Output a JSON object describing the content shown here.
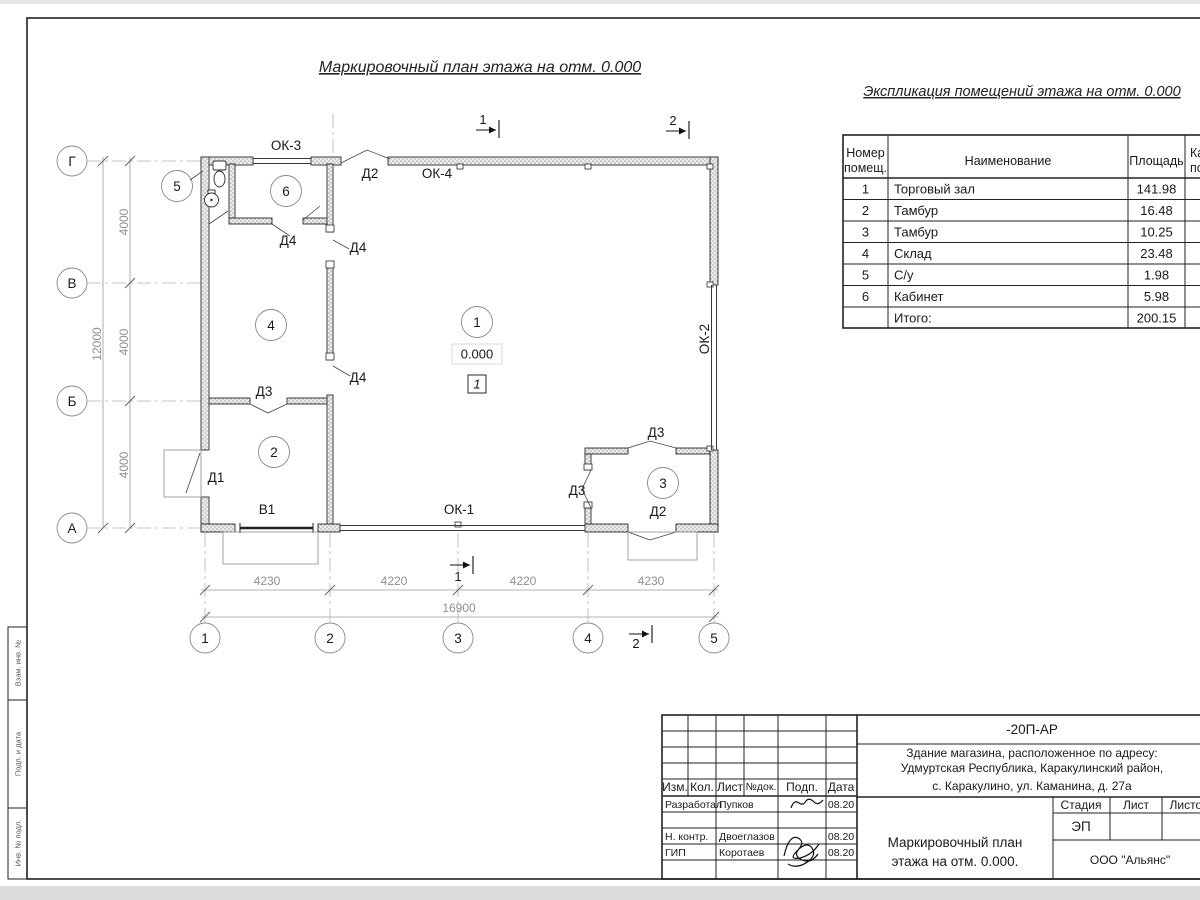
{
  "titles": {
    "main": "Маркировочный план этажа на отм. 0.000",
    "spec": "Экспликация помещений этажа на отм. 0.000"
  },
  "spec_table": {
    "header": {
      "num1": "Номер",
      "num2": "помещ.",
      "name": "Наименование",
      "area": "Площадь",
      "cut1": "Ка",
      "cut2": "по"
    },
    "rows": [
      {
        "num": "1",
        "name": "Торговый зал",
        "area": "141.98"
      },
      {
        "num": "2",
        "name": "Тамбур",
        "area": "16.48"
      },
      {
        "num": "3",
        "name": "Тамбур",
        "area": "10.25"
      },
      {
        "num": "4",
        "name": "Склад",
        "area": "23.48"
      },
      {
        "num": "5",
        "name": "С/у",
        "area": "1.98"
      },
      {
        "num": "6",
        "name": "Кабинет",
        "area": "5.98"
      },
      {
        "num": "",
        "name": "Итого:",
        "area": "200.15"
      }
    ]
  },
  "plan": {
    "room_bubbles": {
      "r1": "1",
      "r2": "2",
      "r3": "3",
      "r4": "4",
      "r5": "5",
      "r6": "6"
    },
    "windows": {
      "ok1": "ОК-1",
      "ok2": "ОК-2",
      "ok3": "ОК-3",
      "ok4": "ОК-4"
    },
    "doors": {
      "d1": "Д1",
      "d2_top": "Д2",
      "d2_r3": "Д2",
      "d3_axis": "Д3",
      "d3_r3top": "Д3",
      "d3_r3left": "Д3",
      "d4_r6": "Д4",
      "d4_p1": "Д4",
      "d4_p2": "Д4",
      "v1": "В1"
    },
    "elevation": "0.000",
    "floor_mark": "1",
    "section1": "1",
    "section2": "2"
  },
  "axes": {
    "bottom": [
      "1",
      "2",
      "3",
      "4",
      "5"
    ],
    "left": [
      "Г",
      "В",
      "Б",
      "А"
    ]
  },
  "dims": {
    "b": [
      "4230",
      "4220",
      "4220",
      "4230"
    ],
    "btotal": "16900",
    "l": [
      "4000",
      "4000",
      "4000"
    ],
    "ltotal": "12000"
  },
  "titleblock": {
    "code": "-20П-АР",
    "object_line1": "Здание магазина, расположенное по адресу:",
    "object_line2": "Удмуртская Республика, Каракулинский район,",
    "object_line3": "с. Каракулино, ул. Каманина, д. 27а",
    "col_izm": "Изм.",
    "col_kol": "Кол.",
    "col_list": "Лист",
    "col_ndok": "№док.",
    "col_podp": "Подп.",
    "col_data": "Дата",
    "row1_role": "Разработал",
    "row1_name": "Пупков",
    "row1_date": "08.20",
    "row3_role": "Н. контр.",
    "row3_name": "Двоеглазов",
    "row3_date": "08.20",
    "row4_role": "ГИП",
    "row4_name": "Коротаев",
    "row4_date": "08.20",
    "stage_label": "Стадия",
    "list_label": "Лист",
    "listov_label": "Листов",
    "stage_value": "ЭП",
    "doc_title_line1": "Маркировочный план",
    "doc_title_line2": "этажа на отм. 0.000.",
    "company": "ООО \"Альянс\""
  },
  "stamp": {
    "c1": "Взам. инв. №",
    "c2": "Подп. и дата",
    "c3": "Инв. № подл."
  }
}
